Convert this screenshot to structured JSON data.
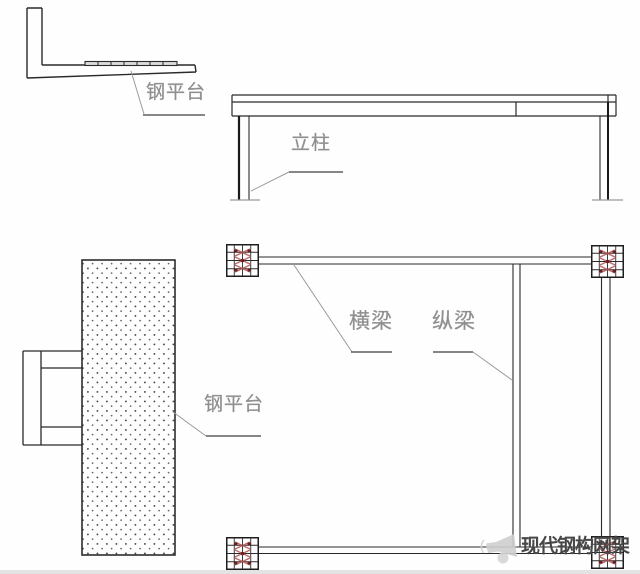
{
  "figure": {
    "type": "steel-platform-structural-diagram",
    "views": {
      "side_detail": {
        "label": "钢平台"
      },
      "elevation": {
        "label": "立柱"
      },
      "plan_platform": {
        "label": "钢平台"
      },
      "plan_frame": {
        "cross_beam_label": "横梁",
        "longitudinal_beam_label": "纵梁"
      }
    },
    "watermark": {
      "icon": "megaphone-icon",
      "text": "现代钢构网架"
    },
    "colors": {
      "background": "#fefefe",
      "drawing_line": "#2a2a2a",
      "label_text": "#8e8e8e",
      "leader_line": "#9a9a9a",
      "underline": "#5f5f5f",
      "column_hatch_red": "#b35151",
      "bolt_dot_red": "#6e1f1f",
      "watermark_text": "#474747",
      "watermark_icon": "#cfcfcf"
    }
  }
}
